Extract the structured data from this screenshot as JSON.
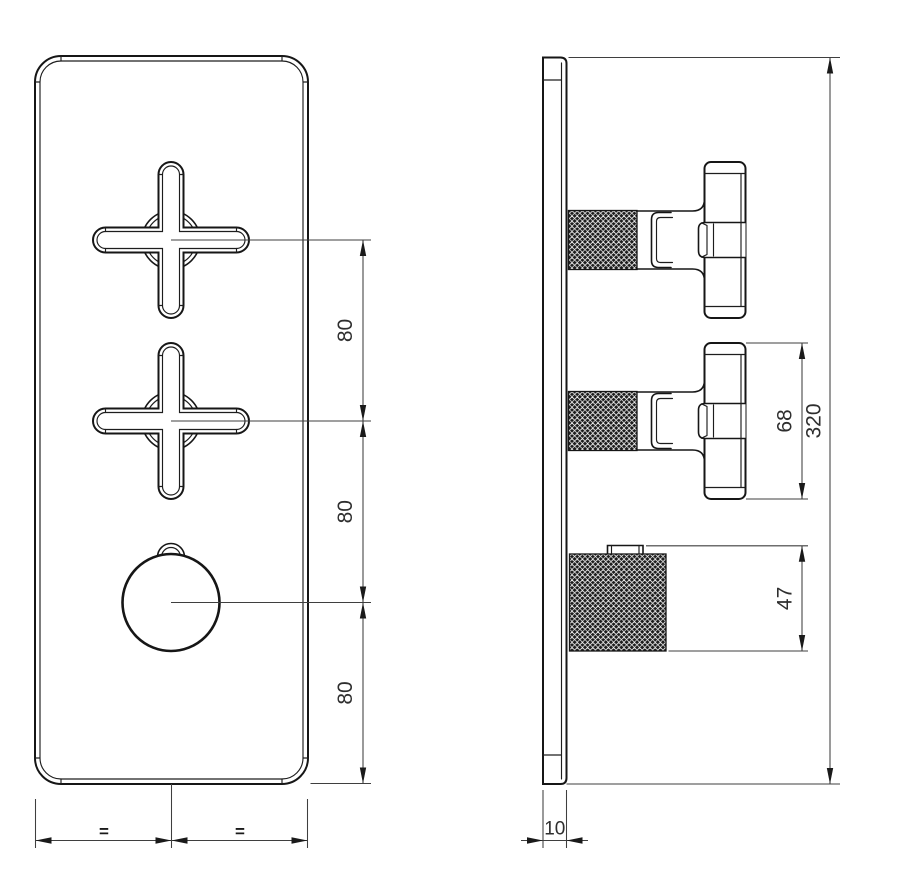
{
  "drawing_type": "technical-dimension-drawing",
  "subject": "concealed-thermostatic-valve-trim-two-cross-handles-one-knob",
  "views": {
    "front_view": "plate-with-two-cross-handles-and-round-knob",
    "side_view": "plate-profile-with-knurled-handles"
  },
  "dimensions": {
    "spacing_top": "80",
    "spacing_middle": "80",
    "spacing_bottom": "80",
    "overall_height": "320",
    "cross_handle_span": "68",
    "knob_height": "47",
    "plate_thickness": "10",
    "equal_left": "=",
    "equal_right": "="
  },
  "colors": {
    "background": "#ffffff",
    "contour_line": "#161616",
    "dimension_line": "#3f3f3f",
    "label_text": "#2e2e2e",
    "knurl_fill": "#1c1c1c"
  }
}
